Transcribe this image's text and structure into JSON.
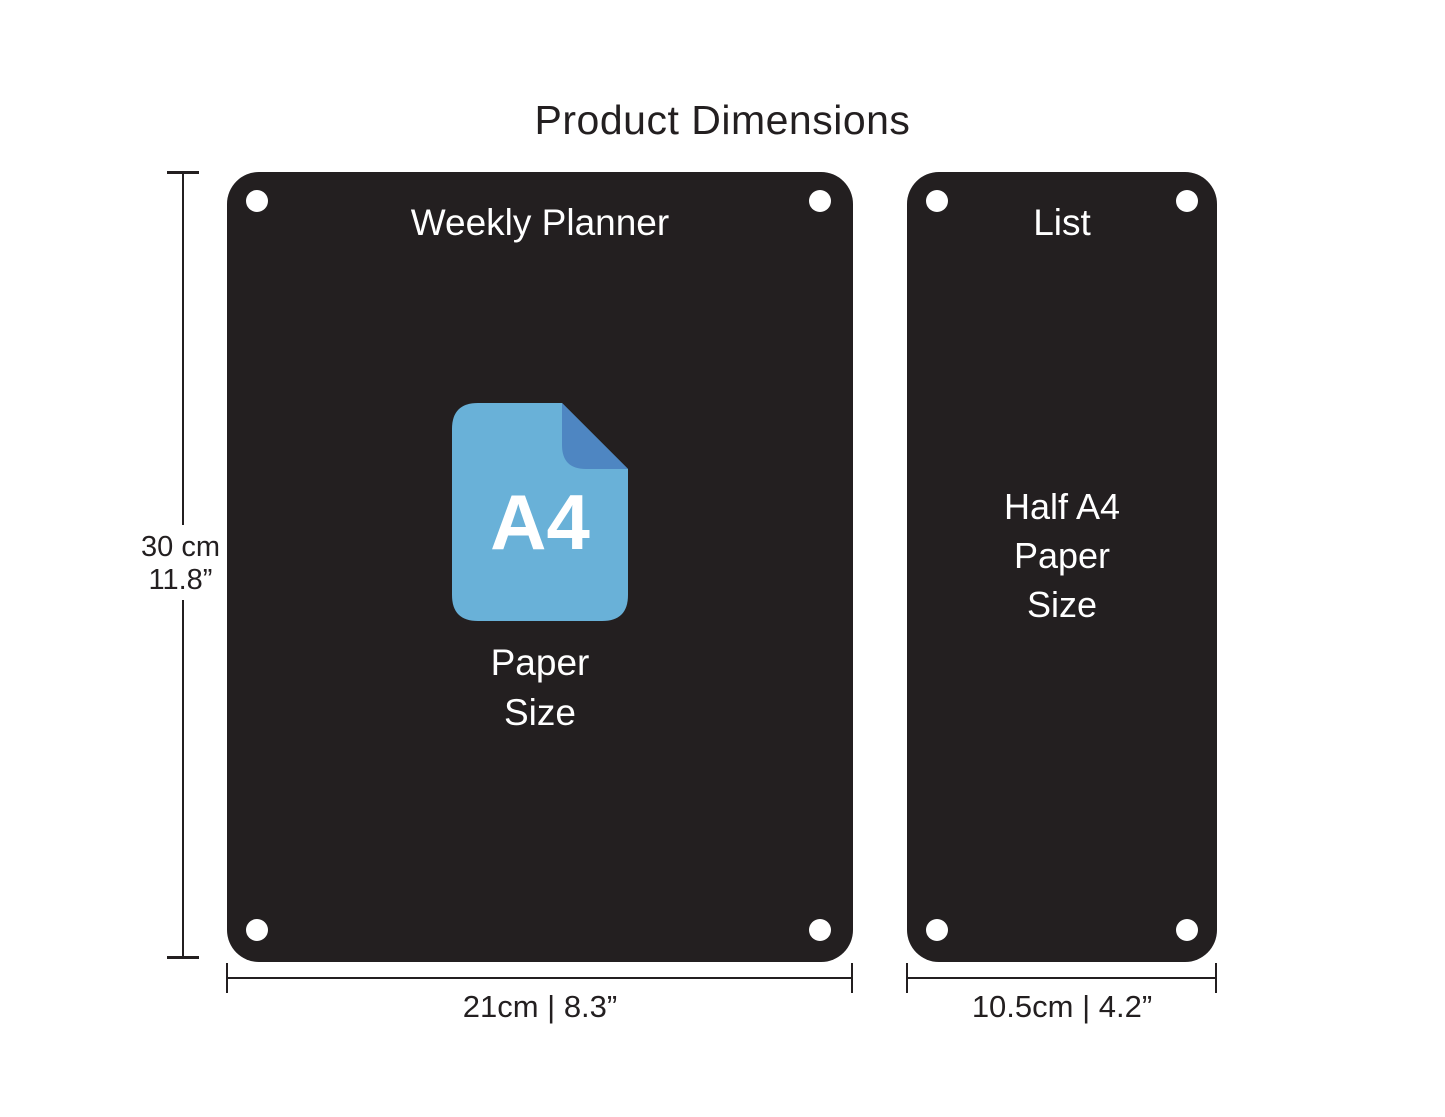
{
  "title": "Product Dimensions",
  "colors": {
    "page_bg": "#ffffff",
    "panel_bg": "#231f20",
    "ink": "#231f20",
    "light": "#ffffff",
    "icon_body": "#69b1d8",
    "icon_fold": "#4e86c2"
  },
  "height_dim": {
    "labels": [
      "30 cm",
      "11.8”"
    ]
  },
  "panels": [
    {
      "label": "Weekly Planner",
      "icon": "a4-paper-icon",
      "icon_label": "A4",
      "caption_lines": [
        "Paper",
        "Size"
      ],
      "width_label": "21cm | 8.3”"
    },
    {
      "label": "List",
      "caption_lines": [
        "Half A4",
        "Paper",
        "Size"
      ],
      "width_label": "10.5cm | 4.2”"
    }
  ]
}
